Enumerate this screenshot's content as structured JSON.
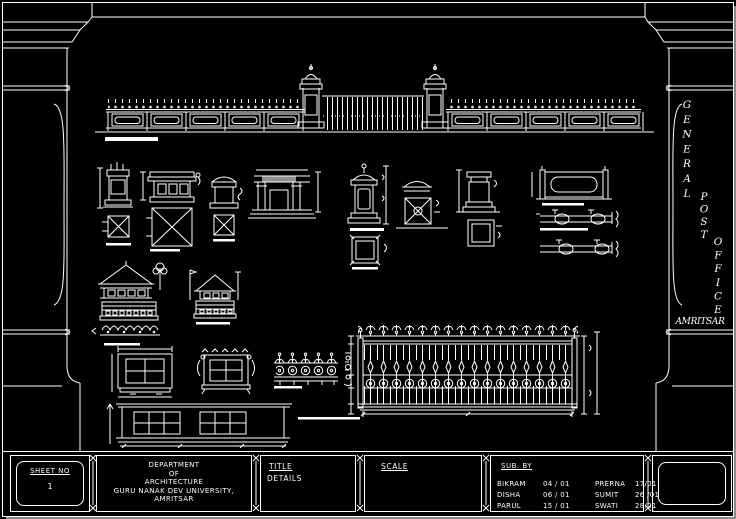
{
  "side_panel": {
    "general": "GENERAL",
    "post": "POST",
    "office": "OFFICE",
    "city": "AMRITSAR"
  },
  "title_block": {
    "sheet_no_label": "SHEET NO",
    "sheet_no_value": "1",
    "department_lines": [
      "DEPARTMENT",
      "OF",
      "ARCHITECTURE",
      "GURU NANAK DEV UNIVERSITY,",
      "AMRITSAR"
    ],
    "title_label": "TITLE",
    "title_value": "DETAILS",
    "scale_label": "SCALE",
    "sub_by_label": "SUB. BY",
    "submissions": [
      {
        "name": "BIKRAM",
        "date": "04 / 01"
      },
      {
        "name": "DISHA",
        "date": "06 / 01"
      },
      {
        "name": "PARUL",
        "date": "15 / 01"
      },
      {
        "name": "PRERNA",
        "date": "17/01"
      },
      {
        "name": "SUMIT",
        "date": "26 /01"
      },
      {
        "name": "SWATI",
        "date": "28/01"
      }
    ]
  },
  "colors": {
    "background": "#000000",
    "line": "#ffffff"
  }
}
